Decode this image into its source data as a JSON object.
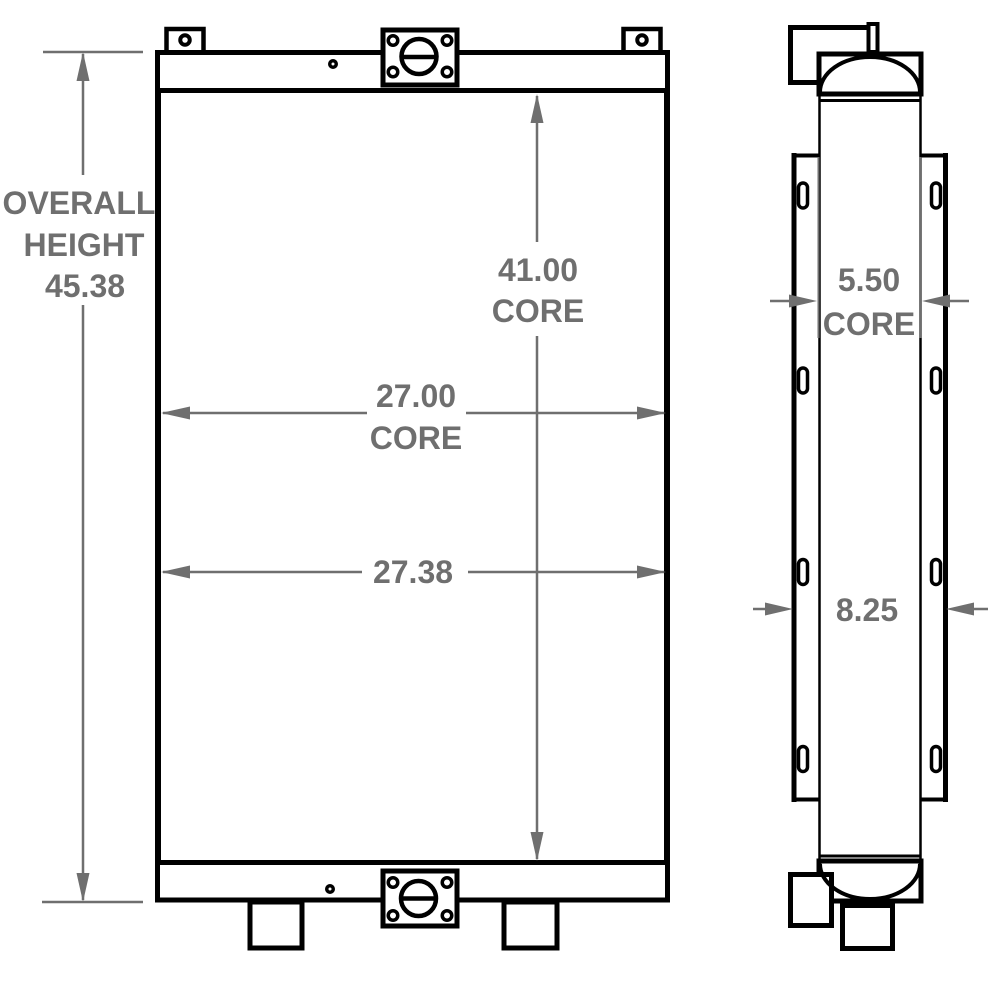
{
  "drawing": {
    "colors": {
      "outline": "#000000",
      "dimension": "#6f6f6f",
      "background": "#ffffff"
    },
    "front_view": {
      "overall_height_word1": "OVERALL",
      "overall_height_word2": "HEIGHT",
      "overall_height_value": "45.38",
      "core_height_value": "41.00",
      "core_height_label": "CORE",
      "core_width_value": "27.00",
      "core_width_label": "CORE",
      "overall_width_value": "27.38"
    },
    "side_view": {
      "core_depth_value": "5.50",
      "core_depth_label": "CORE",
      "overall_depth_value": "8.25"
    }
  }
}
